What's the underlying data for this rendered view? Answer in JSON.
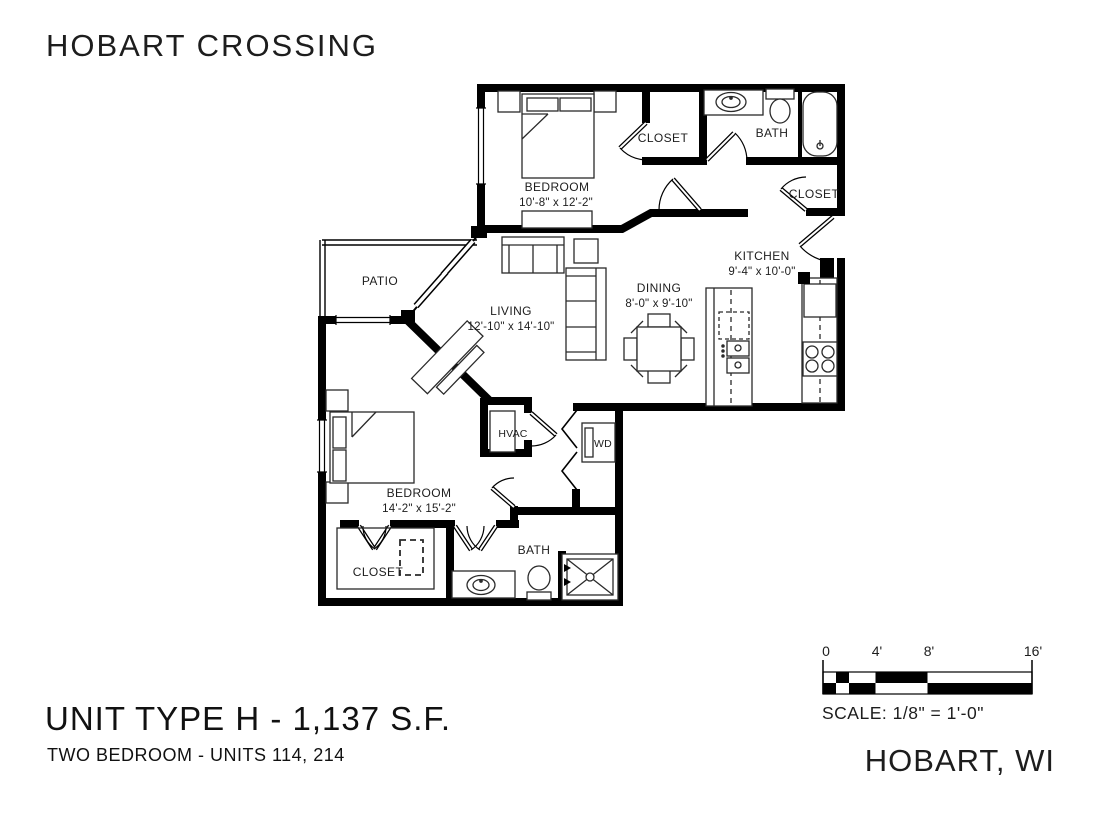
{
  "header": {
    "project_title": "HOBART CROSSING"
  },
  "plan": {
    "rooms": {
      "bedroom1": {
        "name": "BEDROOM",
        "dims": "10'-8\" x 12'-2\""
      },
      "closet1": {
        "name": "CLOSET"
      },
      "bath1": {
        "name": "BATH"
      },
      "entry_closet": {
        "name": "CLOSET"
      },
      "patio": {
        "name": "PATIO"
      },
      "living": {
        "name": "LIVING",
        "dims": "12'-10\" x 14'-10\""
      },
      "dining": {
        "name": "DINING",
        "dims": "8'-0\" x 9'-10\""
      },
      "kitchen": {
        "name": "KITCHEN",
        "dims": "9'-4\" x 10'-0\""
      },
      "hvac": {
        "name": "HVAC"
      },
      "wd": {
        "name": "WD"
      },
      "bedroom2": {
        "name": "BEDROOM",
        "dims": "14'-2\" x 15'-2\""
      },
      "closet2": {
        "name": "CLOSET"
      },
      "bath2": {
        "name": "BATH"
      }
    }
  },
  "scale_bar": {
    "tick_labels": [
      "0",
      "4'",
      "8'",
      "16'"
    ],
    "caption": "SCALE: 1/8\" = 1'-0\""
  },
  "footer": {
    "unit_title": "UNIT TYPE H - 1,137 S.F.",
    "unit_subtitle": "TWO BEDROOM - UNITS 114, 214",
    "location": "HOBART, WI"
  },
  "colors": {
    "ink": "#000000",
    "paper": "#ffffff"
  }
}
